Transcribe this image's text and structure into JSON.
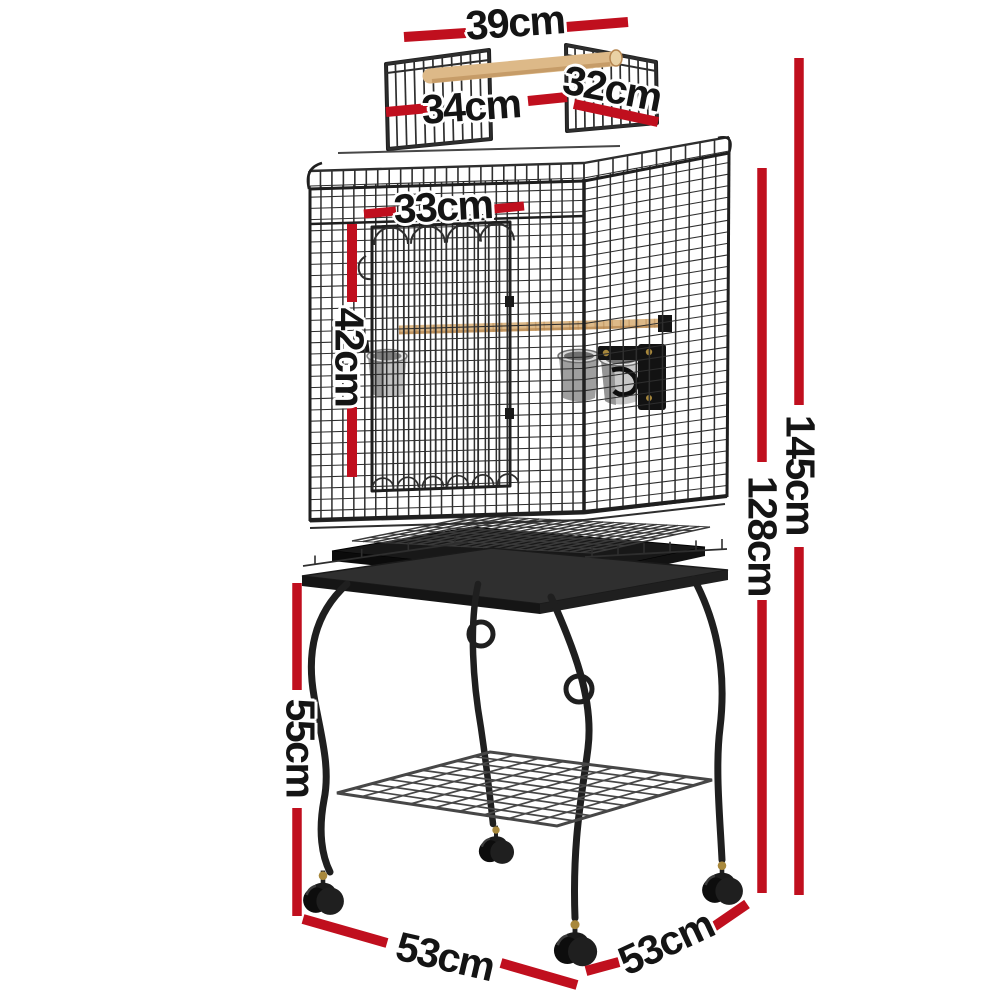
{
  "diagram": {
    "type": "product-dimension-diagram",
    "subject": "open-top bird cage on wheeled stand"
  },
  "measurements": {
    "top_span": "39cm",
    "roof_panel_front": "34cm",
    "roof_panel_side": "32cm",
    "upper_front_width": "33cm",
    "cage_body_height": "42cm",
    "total_height": "145cm",
    "height_to_cage_top": "128cm",
    "stand_height": "55cm",
    "base_front_width": "53cm",
    "base_side_depth": "53cm"
  },
  "colors": {
    "red": "#C00F1E",
    "ink": "#141414",
    "bg": "#FFFFFF",
    "metal": "#2E2E2E",
    "metal2": "#474747",
    "metal3": "#3A3A3A",
    "frame": "#1F1F1F",
    "wood": "#DDB988",
    "woodDark": "#B5854F",
    "steel": "#C9C9C9",
    "brass": "#A8883C"
  }
}
